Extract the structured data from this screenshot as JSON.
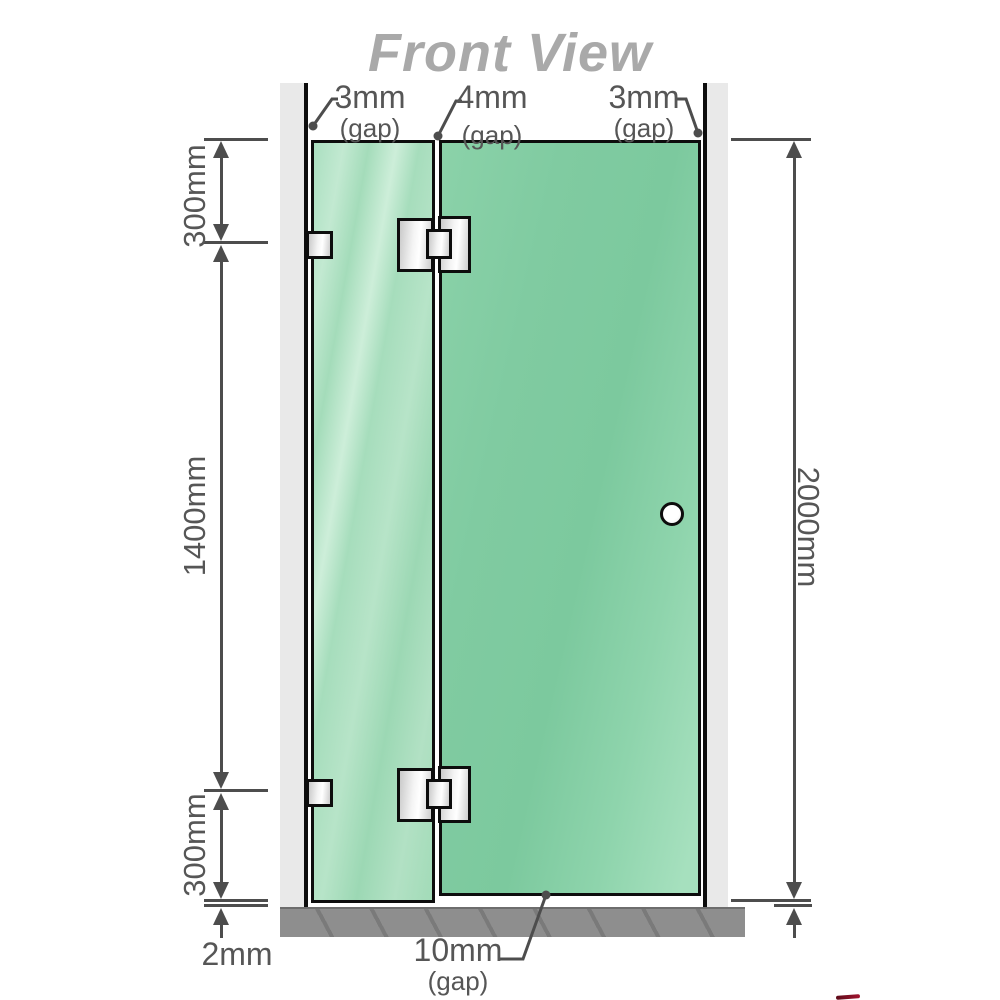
{
  "title": "Front View",
  "gap_labels": {
    "top_left": {
      "value": "3mm",
      "suffix": "(gap)"
    },
    "top_middle": {
      "value": "4mm",
      "suffix": "(gap)"
    },
    "top_right": {
      "value": "3mm",
      "suffix": "(gap)"
    },
    "bottom": {
      "value": "10mm",
      "suffix": "(gap)"
    }
  },
  "dimensions": {
    "left_top": "300mm",
    "left_middle": "1400mm",
    "left_bottom": "300mm",
    "bottom_left": "2mm",
    "right": "2000mm"
  },
  "colors": {
    "glass_fixed": "#a9dec0",
    "glass_door": "#7fcba1",
    "wall": "#e9e9e9",
    "floor": "#8e8e8e",
    "line": "#4d4d4d",
    "text": "#565656",
    "title": "#a9a9a9",
    "outline": "#0d0d0d"
  }
}
